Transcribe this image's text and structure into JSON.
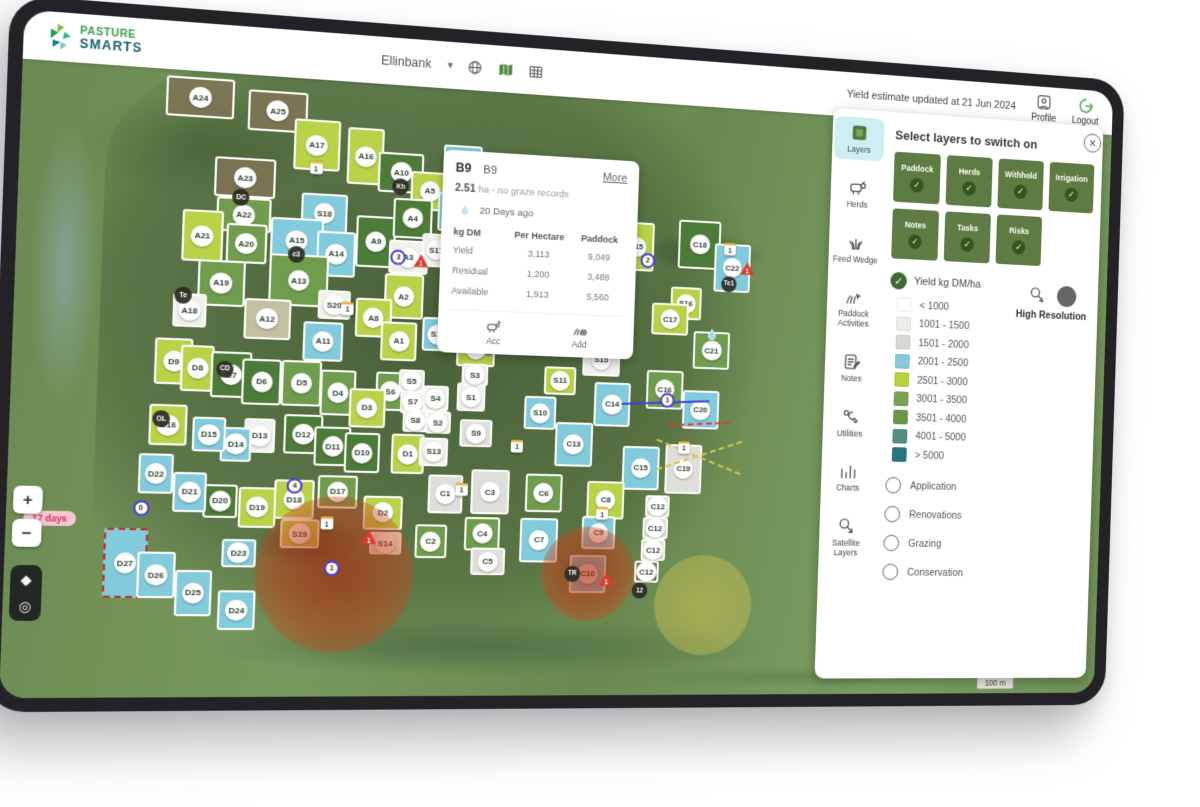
{
  "header": {
    "brand_line1": "PASTURE",
    "brand_line2": "SMARTS",
    "farm_selector": "Ellinbank",
    "status_text": "Yield estimate updated at 21 Jun 2024",
    "profile_label": "Profile",
    "logout_label": "Logout"
  },
  "popup": {
    "code": "B9",
    "name": "B9",
    "more_label": "More",
    "area_value": "2.51",
    "area_rest": "ha - no graze records",
    "last_grazed": "20 Days ago",
    "table": {
      "corner": "kg DM",
      "columns": [
        "Per Hectare",
        "Paddock"
      ],
      "rows": [
        {
          "label": "Yield",
          "per_hectare": "3,113",
          "paddock": "9,049"
        },
        {
          "label": "Residual",
          "per_hectare": "1,200",
          "paddock": "3,488"
        },
        {
          "label": "Available",
          "per_hectare": "1,913",
          "paddock": "5,560"
        }
      ]
    },
    "actions": [
      {
        "label": "Acc",
        "icon": "herd-add"
      },
      {
        "label": "Add",
        "icon": "grass-add"
      }
    ]
  },
  "panel": {
    "title": "Select layers to switch on",
    "rail": [
      {
        "label": "Layers",
        "icon": "layers",
        "active": true
      },
      {
        "label": "Herds",
        "icon": "herds",
        "active": false
      },
      {
        "label": "Feed Wedge",
        "icon": "feed",
        "active": false
      },
      {
        "label": "Paddock Activities",
        "icon": "activities",
        "active": false
      },
      {
        "label": "Notes",
        "icon": "notes",
        "active": false
      },
      {
        "label": "Utilities",
        "icon": "utilities",
        "active": false
      },
      {
        "label": "Charts",
        "icon": "charts",
        "active": false
      },
      {
        "label": "Satellite Layers",
        "icon": "satellite",
        "active": false
      }
    ],
    "toggles": [
      "Paddock",
      "Herds",
      "Withhold",
      "Irrigation",
      "Notes",
      "Tasks",
      "Risks"
    ],
    "yield_label": "Yield kg DM/ha",
    "legend": [
      {
        "label": "< 1000",
        "color": "#ffffff"
      },
      {
        "label": "1001 - 1500",
        "color": "#ededea"
      },
      {
        "label": "1501 - 2000",
        "color": "#d9d9d4"
      },
      {
        "label": "2001 - 2500",
        "color": "#85c9da"
      },
      {
        "label": "2501 - 3000",
        "color": "#b5d33b"
      },
      {
        "label": "3001 - 3500",
        "color": "#79a351"
      },
      {
        "label": "3501 - 4000",
        "color": "#6a964a"
      },
      {
        "label": "4001 - 5000",
        "color": "#53907f"
      },
      {
        "label": "> 5000",
        "color": "#26777b"
      }
    ],
    "high_res_label": "High Resolution",
    "radios": [
      "Application",
      "Renovations",
      "Grazing",
      "Conservation"
    ]
  },
  "map": {
    "zoom_in": "+",
    "zoom_out": "−",
    "scale_label": "100 m",
    "alert_pill": "17 days",
    "palette": {
      "lime": "#b9d348",
      "blue": "#82cbdc",
      "green": "#6f9d4d",
      "dgreen": "#4d7b3a",
      "gray": "#dededa",
      "white": "#f0f0ec",
      "beige": "#c2c0a0",
      "brown": "rgba(128,116,86,0.85)"
    },
    "paddocks": [
      [
        "A24",
        12.5,
        3.5,
        10,
        7,
        "brown"
      ],
      [
        "A25",
        24,
        5,
        9,
        7,
        "brown"
      ],
      [
        "A17",
        30,
        10.5,
        7,
        9,
        "lime"
      ],
      [
        "A16",
        37.5,
        12,
        5.5,
        10,
        "lime"
      ],
      [
        "A10",
        43,
        14.5,
        7,
        7,
        "dgreen"
      ],
      [
        "A5",
        47.5,
        17.5,
        6,
        7,
        "lime"
      ],
      [
        "A7",
        52.5,
        13,
        6,
        8,
        "blue"
      ],
      [
        "A6",
        51.5,
        21,
        5.5,
        7,
        "blue"
      ],
      [
        "A23",
        19.5,
        17,
        9,
        7,
        "brown"
      ],
      [
        "A22",
        19.5,
        23.5,
        8,
        6,
        "green"
      ],
      [
        "A21",
        13.5,
        27.5,
        6,
        9,
        "lime"
      ],
      [
        "A20",
        20,
        28.5,
        6,
        7,
        "green"
      ],
      [
        "S18",
        31.5,
        22.5,
        7,
        7,
        "blue"
      ],
      [
        "A15",
        27.5,
        27.5,
        8,
        8,
        "blue"
      ],
      [
        "A14",
        33.5,
        29.5,
        6,
        8,
        "blue"
      ],
      [
        "A9",
        39.5,
        27,
        6,
        9,
        "dgreen"
      ],
      [
        "A4",
        45,
        22.5,
        6,
        7,
        "dgreen"
      ],
      [
        "A3",
        44.5,
        29.5,
        6,
        6,
        "white"
      ],
      [
        "S17",
        48.8,
        28,
        4.5,
        6,
        "white"
      ],
      [
        "A19",
        16.5,
        35.5,
        7,
        8,
        "green"
      ],
      [
        "A18",
        12,
        40.5,
        5,
        6,
        "white"
      ],
      [
        "A13",
        28,
        34.5,
        9,
        9,
        "green"
      ],
      [
        "A12",
        23.5,
        41.5,
        7,
        7,
        "beige"
      ],
      [
        "S20",
        33.5,
        38.5,
        5,
        5,
        "white"
      ],
      [
        "A11",
        32,
        45,
        6,
        7,
        "blue"
      ],
      [
        "A2",
        44,
        36.5,
        6,
        8,
        "lime"
      ],
      [
        "A8",
        39.5,
        40.5,
        5.5,
        7,
        "lime"
      ],
      [
        "A1",
        43.5,
        44.5,
        5.5,
        7,
        "lime"
      ],
      [
        "S12",
        49.5,
        43,
        5,
        6,
        "blue"
      ],
      [
        "B1",
        55.5,
        45.5,
        6,
        6,
        "lime"
      ],
      [
        "B2",
        58.5,
        39.5,
        5.5,
        7,
        "blue"
      ],
      [
        "B9",
        66,
        38,
        6,
        8,
        "blue"
      ],
      [
        "B14",
        76.5,
        39,
        7,
        8,
        "blue"
      ],
      [
        "B15",
        80.5,
        25.5,
        6,
        9,
        "lime"
      ],
      [
        "C18",
        91,
        24.5,
        7,
        9,
        "dgreen"
      ],
      [
        "C22",
        96.5,
        28.5,
        6,
        9,
        "blue"
      ],
      [
        "S16",
        89,
        35.5,
        5,
        6,
        "lime"
      ],
      [
        "C17",
        86.5,
        38.5,
        6,
        6,
        "lime"
      ],
      [
        "S15",
        75.5,
        46.5,
        6,
        6,
        "white"
      ],
      [
        "S11",
        69,
        50.5,
        5,
        5,
        "lime"
      ],
      [
        "C16",
        86,
        51.5,
        6,
        7,
        "green"
      ],
      [
        "C21",
        93.5,
        44,
        6,
        7,
        "green"
      ],
      [
        "C20",
        92,
        55,
        6,
        7,
        "blue"
      ],
      [
        "C14",
        77.5,
        54.5,
        6,
        8,
        "blue"
      ],
      [
        "S10",
        66,
        56.5,
        5,
        6,
        "blue"
      ],
      [
        "C13",
        71.5,
        62,
        6,
        8,
        "blue"
      ],
      [
        "C15",
        82.5,
        66,
        6,
        8,
        "blue"
      ],
      [
        "C19",
        89.5,
        66,
        6,
        9,
        "gray"
      ],
      [
        "S6",
        42.5,
        53.5,
        4.5,
        7,
        "green"
      ],
      [
        "S5",
        45.7,
        51.5,
        4,
        4,
        "white"
      ],
      [
        "S7",
        46,
        55.2,
        4,
        4,
        "white"
      ],
      [
        "S4",
        49.5,
        54.5,
        4,
        4.5,
        "white"
      ],
      [
        "S1",
        55,
        54,
        4.5,
        5,
        "white"
      ],
      [
        "S3",
        55.5,
        50,
        4,
        4,
        "white"
      ],
      [
        "S8",
        46.5,
        58.5,
        4,
        4,
        "white"
      ],
      [
        "S2",
        50,
        58.8,
        4,
        4,
        "white"
      ],
      [
        "S9",
        56,
        60.5,
        5,
        5,
        "gray"
      ],
      [
        "D9",
        10,
        49.5,
        5.5,
        8,
        "lime"
      ],
      [
        "D8",
        13.5,
        50.5,
        5,
        8,
        "lime"
      ],
      [
        "D7",
        18.5,
        51.5,
        6,
        8,
        "dgreen"
      ],
      [
        "D6",
        23,
        52.5,
        6,
        8,
        "dgreen"
      ],
      [
        "D5",
        29,
        52.5,
        6,
        8,
        "green"
      ],
      [
        "D4",
        34.5,
        54,
        5.5,
        8,
        "green"
      ],
      [
        "D3",
        39,
        56.5,
        5.5,
        7,
        "lime"
      ],
      [
        "D12",
        29.5,
        61.5,
        6,
        7,
        "dgreen"
      ],
      [
        "D11",
        34,
        63.5,
        5.5,
        7,
        "dgreen"
      ],
      [
        "D10",
        38.5,
        64.5,
        5.5,
        7,
        "dgreen"
      ],
      [
        "D1",
        45.5,
        64.5,
        5,
        7,
        "lime"
      ],
      [
        "S13",
        49.5,
        64,
        4.5,
        5,
        "white"
      ],
      [
        "D13",
        23,
        62,
        4.5,
        6,
        "white"
      ],
      [
        "D14",
        19.5,
        63.5,
        4.5,
        6,
        "blue"
      ],
      [
        "D15",
        15.5,
        62,
        5,
        6,
        "blue"
      ],
      [
        "D16",
        9.5,
        60.5,
        5.5,
        7,
        "lime"
      ],
      [
        "D17",
        35,
        71.5,
        6,
        6,
        "green"
      ],
      [
        "D18",
        28.5,
        73,
        6,
        7,
        "lime"
      ],
      [
        "D19",
        23,
        74.5,
        5.5,
        7,
        "lime"
      ],
      [
        "D20",
        17.5,
        73.5,
        5,
        6,
        "dgreen"
      ],
      [
        "D21",
        13,
        72,
        5,
        7,
        "blue"
      ],
      [
        "D22",
        8,
        69,
        5,
        7,
        "blue"
      ],
      [
        "D2",
        42,
        75,
        6,
        6,
        "lime"
      ],
      [
        "S19",
        29.5,
        79,
        6,
        5,
        "lime"
      ],
      [
        "D23",
        20.5,
        82.5,
        5,
        5,
        "blue"
      ],
      [
        "D27",
        4,
        84.5,
        6.5,
        12,
        "blue",
        "dashed"
      ],
      [
        "D26",
        8.5,
        86.5,
        5.5,
        8,
        "blue"
      ],
      [
        "D25",
        14,
        89.5,
        5.5,
        8,
        "blue"
      ],
      [
        "D24",
        20.5,
        92.5,
        5.5,
        7,
        "blue"
      ],
      [
        "S14",
        42.5,
        80.5,
        5,
        4,
        "white"
      ],
      [
        "C1",
        51.5,
        71.5,
        5.5,
        7,
        "gray"
      ],
      [
        "C3",
        58.5,
        71,
        6,
        8,
        "gray"
      ],
      [
        "C2",
        49.5,
        80,
        5,
        6,
        "green"
      ],
      [
        "C4",
        57.5,
        78.5,
        5.5,
        6,
        "green"
      ],
      [
        "C5",
        58.5,
        83.5,
        5.5,
        5,
        "gray"
      ],
      [
        "C6",
        67,
        71,
        6,
        7,
        "green"
      ],
      [
        "C7",
        66.5,
        79.5,
        6,
        8,
        "blue"
      ],
      [
        "C8",
        77,
        72,
        6,
        7,
        "lime"
      ],
      [
        "C9",
        76,
        78,
        5.5,
        6,
        "blue"
      ],
      [
        "C10",
        74.5,
        85.5,
        6,
        7,
        "blue"
      ],
      [
        "C12",
        85.5,
        73,
        4,
        4,
        "gray"
      ],
      [
        "C12",
        85.2,
        77,
        4,
        4,
        "gray"
      ],
      [
        "C12",
        85,
        81,
        4,
        4,
        "gray"
      ],
      [
        "C12",
        84,
        85,
        4,
        4,
        "brown"
      ]
    ],
    "dark_badges": [
      [
        "Kh",
        43,
        17
      ],
      [
        "c3",
        27.5,
        30
      ],
      [
        "DC",
        19,
        20.5
      ],
      [
        "Te",
        11,
        38
      ],
      [
        "CD",
        17.5,
        50.5
      ],
      [
        "OL",
        8.5,
        59.5
      ],
      [
        "Te1",
        96,
        31.5
      ],
      [
        "TR",
        72,
        85.5
      ],
      [
        "12",
        83,
        88.5
      ]
    ],
    "yellow_badges": [
      [
        "1",
        30,
        14.5
      ],
      [
        "1",
        35.5,
        39
      ],
      [
        "1",
        96,
        25
      ],
      [
        "1",
        54,
        70.5
      ],
      [
        "1",
        76.5,
        74.5
      ],
      [
        "1",
        89.5,
        62
      ],
      [
        "1",
        33.5,
        77
      ],
      [
        "1",
        62.5,
        62.5
      ],
      [
        "1",
        74,
        35.5
      ]
    ],
    "warn_markers": [
      [
        "1",
        53.5,
        44.5
      ],
      [
        "1",
        46.5,
        30
      ],
      [
        "1",
        99,
        28.5
      ],
      [
        "1",
        77.5,
        86.5
      ],
      [
        "1",
        40,
        79.5
      ]
    ],
    "blue_markers": [
      [
        "3",
        43,
        29.5
      ],
      [
        "2",
        82.5,
        28
      ],
      [
        "8",
        78,
        36.5
      ],
      [
        "1",
        86.5,
        53.5
      ],
      [
        "1",
        57.5,
        45
      ],
      [
        "4",
        28.5,
        70.5
      ],
      [
        "0",
        6,
        75
      ],
      [
        "1",
        34.5,
        85
      ]
    ],
    "water_drops": [
      [
        93.5,
        41
      ]
    ],
    "risk_circles": [
      {
        "x": 35,
        "y": 86,
        "r": 12,
        "kind": "red"
      },
      {
        "x": 74.5,
        "y": 85.5,
        "r": 7.5,
        "kind": "red"
      },
      {
        "x": 93.5,
        "y": 91,
        "r": 8,
        "kind": "yellow"
      }
    ],
    "route_lines": [
      {
        "x1": 79,
        "y1": 54.2,
        "x2": 93.5,
        "y2": 53.2,
        "color": "#4040d8",
        "dashed": false
      },
      {
        "x1": 87,
        "y1": 57.8,
        "x2": 97,
        "y2": 57,
        "color": "#e03b2f",
        "dashed": true
      },
      {
        "x1": 85,
        "y1": 60.5,
        "x2": 99,
        "y2": 66.5,
        "color": "#d9c44e",
        "dashed": true
      },
      {
        "x1": 85,
        "y1": 66,
        "x2": 99,
        "y2": 60.5,
        "color": "#d9c44e",
        "dashed": true
      }
    ],
    "pill_pos": {
      "x": -7,
      "y": 77
    }
  }
}
